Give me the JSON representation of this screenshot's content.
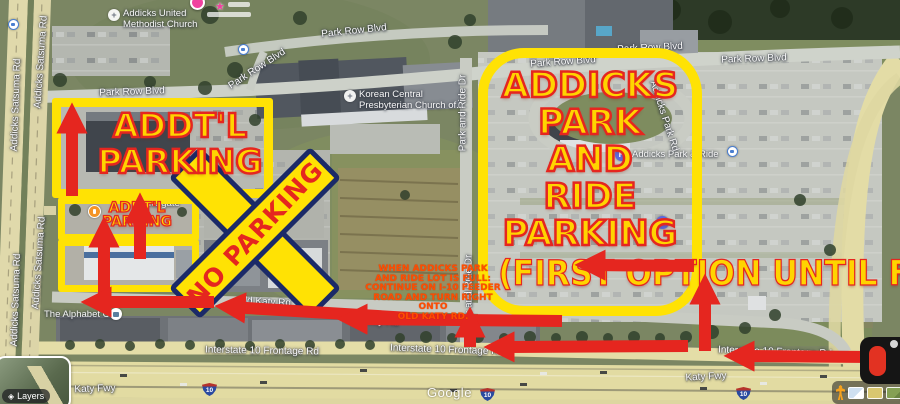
{
  "ann": {
    "pr_lines": [
      "ADDICKS",
      "PARK",
      "AND",
      "RIDE",
      "PARKING"
    ],
    "pr_sub": "(FIRST OPTION UNTIL FULL)",
    "large_lines": [
      "ADDT'L",
      "PARKING"
    ],
    "small_lines": [
      "ADDT'L",
      "PARKING"
    ],
    "no_parking": "NO PARKING",
    "note_lines": [
      "WHEN ADDICKS PARK",
      "AND RIDE LOT IS FULL:",
      "CONTINUE ON I-10 FEEDER",
      "ROAD AND TURN RIGHT",
      "ONTO",
      "OLD KATY RD."
    ]
  },
  "roads": [
    "Addicks Satsuma Rd",
    "Addicks Satsuma Rd",
    "Addicks Satsuma Rd",
    "Addicks Satsuma Rd",
    "Park Row Blvd",
    "Park Row Blvd",
    "Park Row Blvd",
    "Park Row Blvd",
    "Park Row Blvd",
    "Park Row Blvd",
    "Park and Ride Dr",
    "Park and Ride Dr",
    "Addicks Park Rd",
    "Old Katy Rd",
    "Old Katy Rd",
    "Interstate 10 Frontage Rd",
    "Interstate 10 Frontage Rd",
    "Interstate 10 Frontage Rd",
    "Katy Fwy",
    "Katy Fwy"
  ],
  "pois": {
    "methodist": {
      "line1": "Addicks United",
      "line2": "Methodist Church"
    },
    "korean": {
      "line1": "Korean Central",
      "line2": "Presbyterian Church of..."
    },
    "park_ride": "Addicks Park & Ride",
    "alphabet": "The Alphabet Ch",
    "tailgate": "Tailgate",
    "parking_letter": "P"
  },
  "signs": {
    "interstate": "10"
  },
  "ui": {
    "watermark": "Google",
    "layers": "Layers"
  },
  "colors": {
    "annotation_yellow": "#ffe204",
    "annotation_text_yellow": "#ffd400",
    "annotation_red": "#e5261f",
    "note_orange": "#ff4d00",
    "x_navy": "#1b2a68"
  }
}
